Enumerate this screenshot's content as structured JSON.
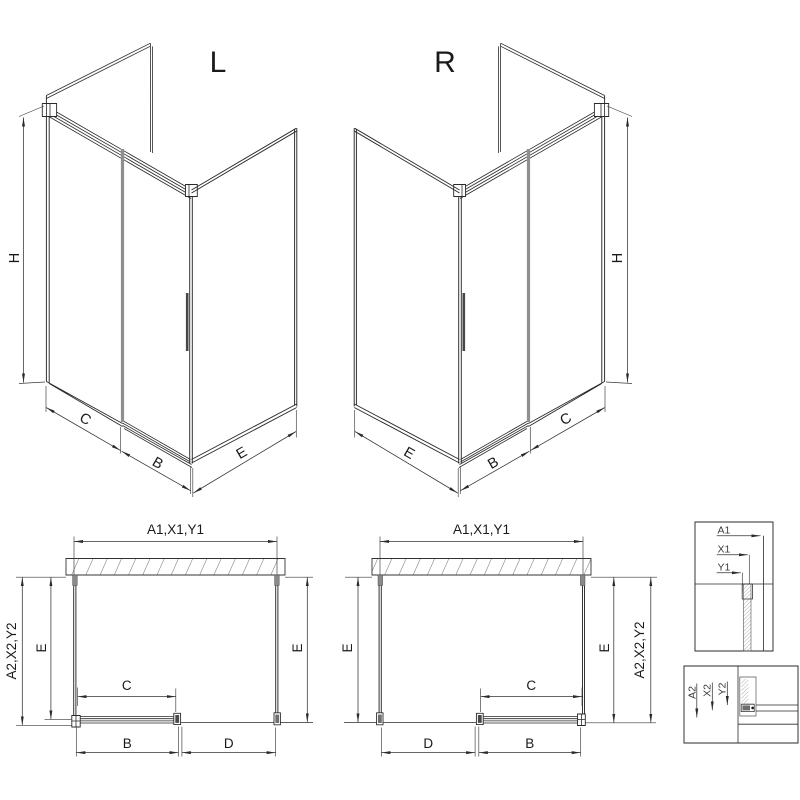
{
  "colors": {
    "background": "#ffffff",
    "line": "#2a2a2a",
    "glass_edge": "#8f8f8f",
    "handle": "#4a4a4a"
  },
  "iso_left": {
    "title": "L",
    "dim_height": "H",
    "dim_fixed": "C",
    "dim_door": "B",
    "dim_side": "E"
  },
  "iso_right": {
    "title": "R",
    "dim_height": "H",
    "dim_fixed": "C",
    "dim_door": "B",
    "dim_side": "E"
  },
  "plan_left": {
    "dim_width_top": "A1,X1,Y1",
    "dim_depth_outer": "A2,X2,Y2",
    "dim_depth_inner_left": "E",
    "dim_depth_right": "E",
    "dim_door_glass": "C",
    "dim_rail": "B",
    "dim_opening": "D"
  },
  "plan_right": {
    "dim_width_top": "A1,X1,Y1",
    "dim_depth_left": "E",
    "dim_depth_inner_right": "E",
    "dim_depth_outer": "A2,X2,Y2",
    "dim_door_glass": "C",
    "dim_rail": "B",
    "dim_opening": "D"
  },
  "detail_width": {
    "dim_a1": "A1",
    "dim_x1": "X1",
    "dim_y1": "Y1"
  },
  "detail_depth": {
    "dim_a2": "A2",
    "dim_x2": "X2",
    "dim_y2": "Y2"
  }
}
